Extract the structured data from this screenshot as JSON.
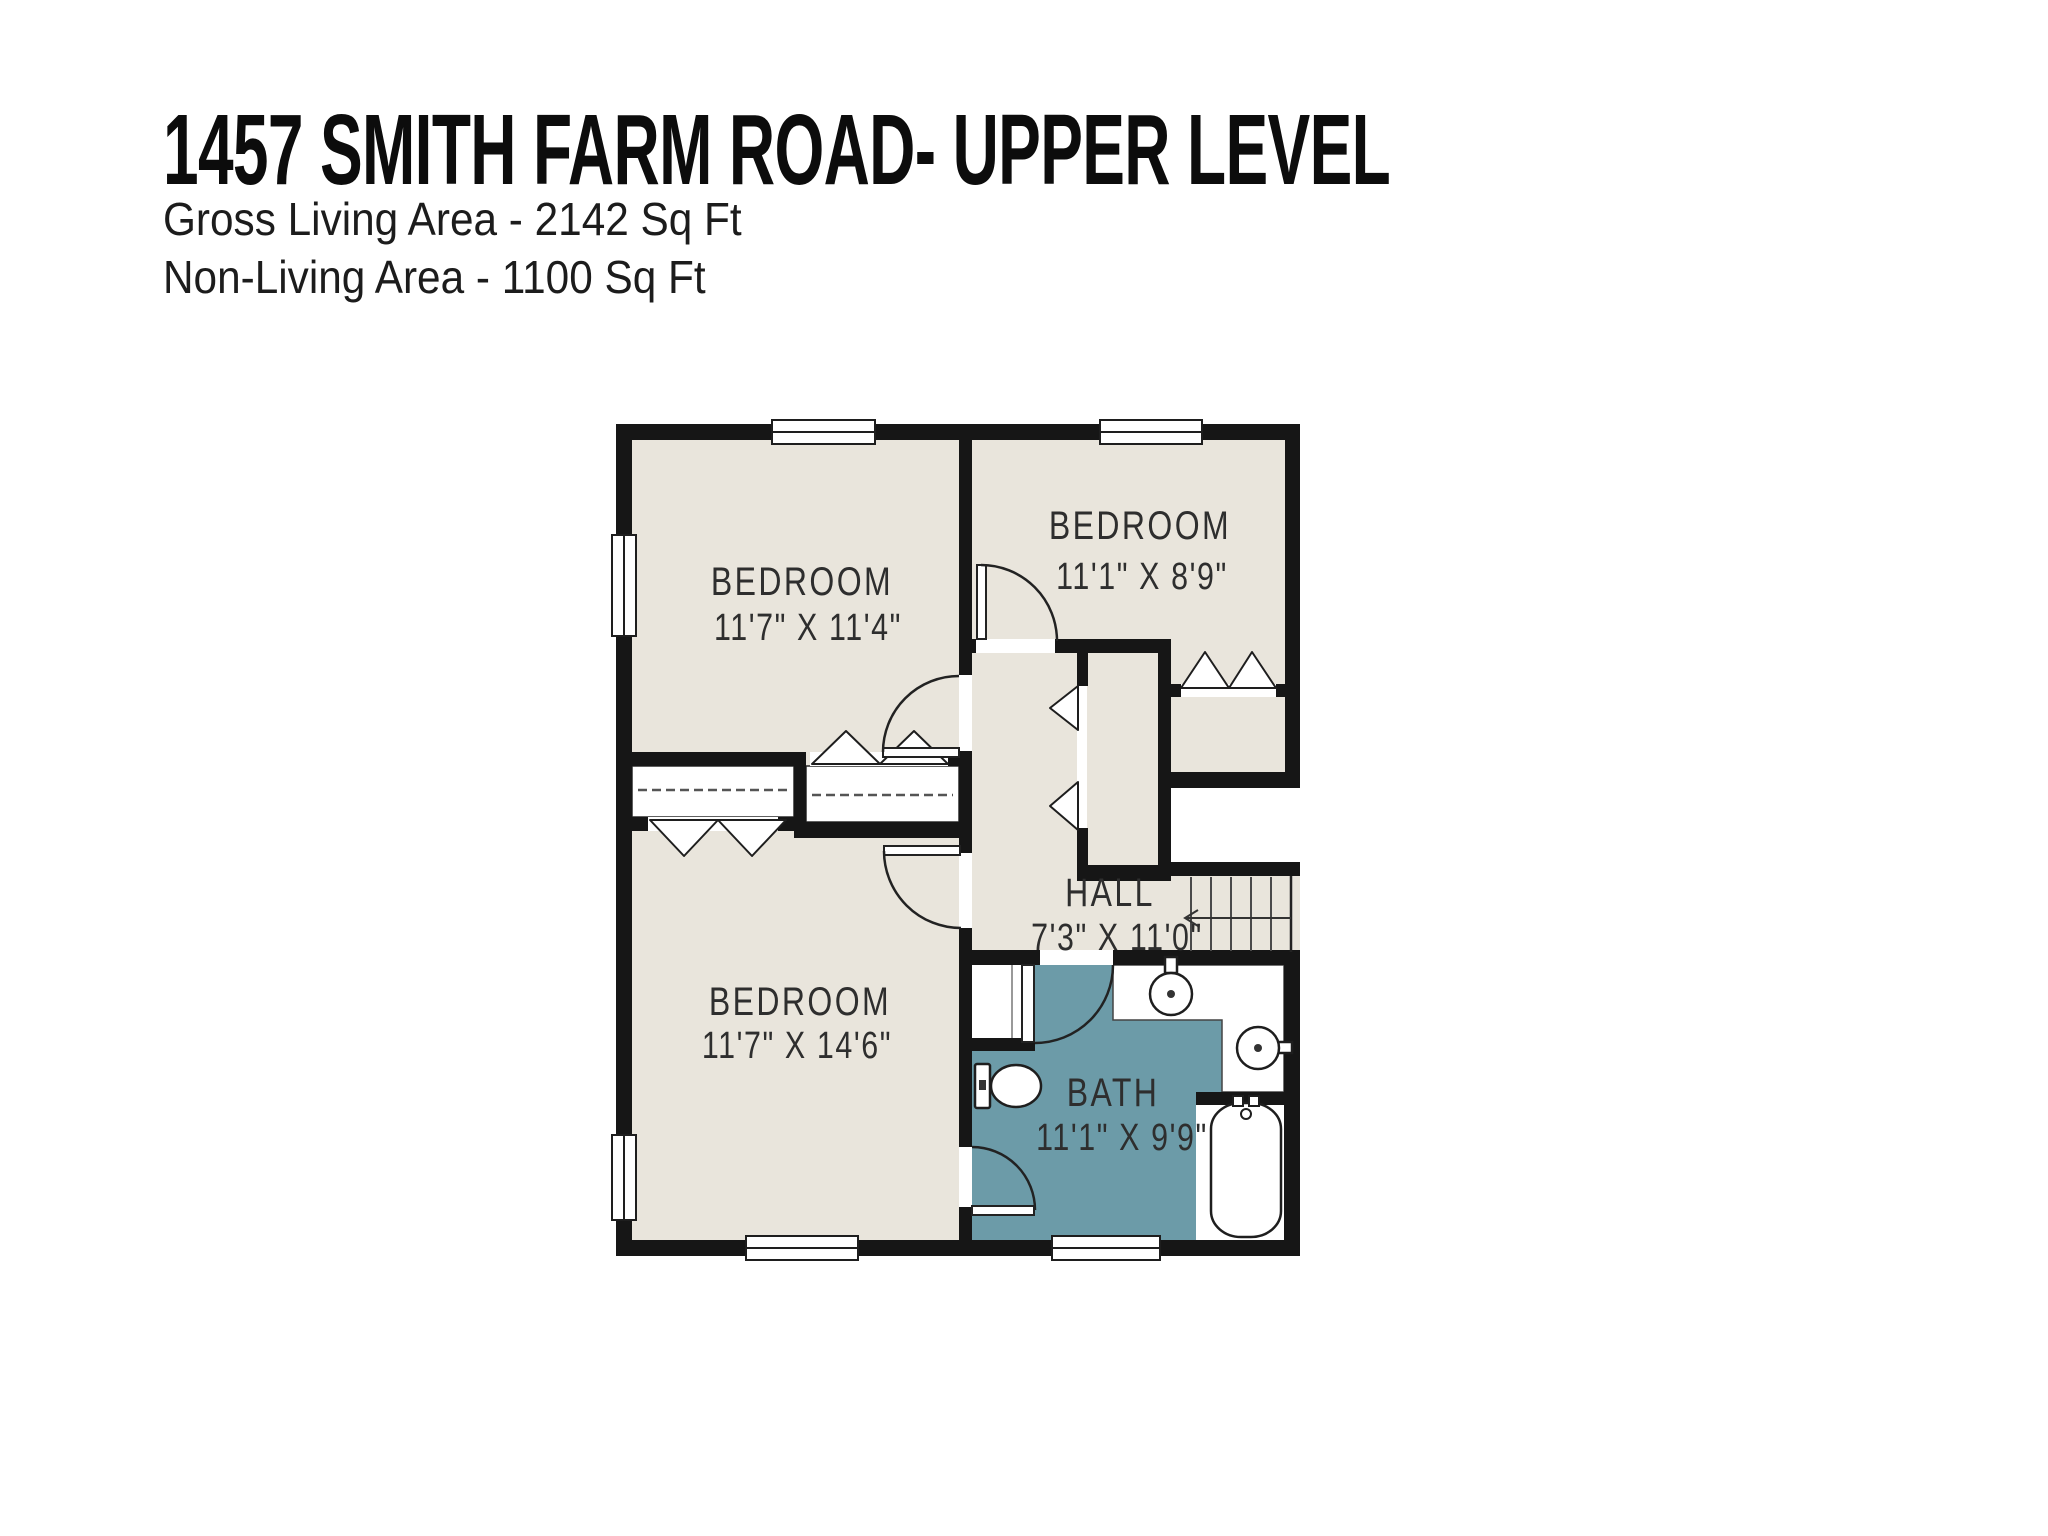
{
  "header": {
    "title": "1457 SMITH FARM ROAD- UPPER LEVEL",
    "gross_living_area": "Gross Living Area - 2142 Sq Ft",
    "non_living_area": "Non-Living Area - 1100 Sq Ft"
  },
  "rooms": {
    "bedroom_top_left": {
      "label": "BEDROOM",
      "dimensions": "11'7\" X 11'4\""
    },
    "bedroom_top_right": {
      "label": "BEDROOM",
      "dimensions": "11'1\" X 8'9\""
    },
    "bedroom_bottom_left": {
      "label": "BEDROOM",
      "dimensions": "11'7\" X 14'6\""
    },
    "hall": {
      "label": "HALL",
      "dimensions": "7'3\" X 11'0\""
    },
    "bath": {
      "label": "BATH",
      "dimensions": "11'1\" X 9'9\""
    }
  },
  "colors": {
    "background": "#ffffff",
    "room_fill": "#e9e5dc",
    "bath_fill": "#6c9ba8",
    "wall": "#161616",
    "text": "#2e2e2e"
  }
}
